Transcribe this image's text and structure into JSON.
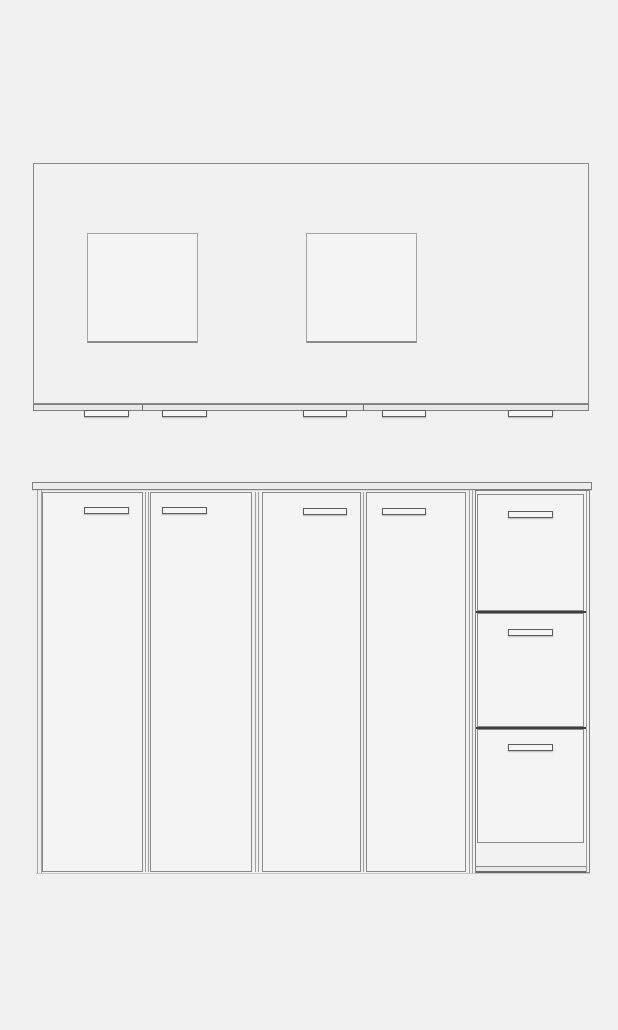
{
  "colors": {
    "background": "#f0f0f0",
    "surface": "#f4f4f4",
    "surface_light": "#f1f1f1",
    "counter_edge": "#ececec",
    "strip": "#e7e7e7",
    "line": "#8a8a8a",
    "divider_dark": "#3f3f3f"
  },
  "views": [
    {
      "name": "plan-view",
      "parts": [
        {
          "name": "countertop-top-surface",
          "kind": "surface-outline",
          "x": 33,
          "y": 163,
          "w": 556,
          "h": 241
        },
        {
          "name": "countertop-cutout-left",
          "kind": "cutout",
          "x": 87,
          "y": 233,
          "w": 111,
          "h": 110
        },
        {
          "name": "countertop-cutout-right",
          "kind": "cutout",
          "x": 306,
          "y": 233,
          "w": 111,
          "h": 110
        },
        {
          "name": "countertop-front-edge-strip",
          "kind": "strip",
          "x": 33,
          "y": 404,
          "w": 556,
          "h": 7
        },
        {
          "name": "front-strip-divider-left",
          "kind": "vline-dark",
          "x": 142,
          "y": 404,
          "w": 1,
          "h": 7
        },
        {
          "name": "front-strip-divider-right",
          "kind": "vline-dark",
          "x": 363,
          "y": 404,
          "w": 1,
          "h": 7
        },
        {
          "name": "plan-handle-1",
          "kind": "handle",
          "x": 84,
          "y": 410,
          "w": 45,
          "h": 7
        },
        {
          "name": "plan-handle-2",
          "kind": "handle",
          "x": 162,
          "y": 410,
          "w": 45,
          "h": 7
        },
        {
          "name": "plan-handle-3",
          "kind": "handle",
          "x": 303,
          "y": 410,
          "w": 44,
          "h": 7
        },
        {
          "name": "plan-handle-4",
          "kind": "handle",
          "x": 382,
          "y": 410,
          "w": 44,
          "h": 7
        },
        {
          "name": "plan-handle-5",
          "kind": "handle",
          "x": 508,
          "y": 410,
          "w": 45,
          "h": 7
        }
      ]
    },
    {
      "name": "elevation-view",
      "parts": [
        {
          "name": "countertop-front-edge",
          "kind": "counter-edge",
          "x": 32,
          "y": 482,
          "w": 560,
          "h": 8
        },
        {
          "name": "left-side-panel-outer-line",
          "kind": "vline",
          "x": 37,
          "y": 490,
          "w": 1,
          "h": 383
        },
        {
          "name": "left-side-panel-inner-line",
          "kind": "vline",
          "x": 41,
          "y": 490,
          "w": 1,
          "h": 383
        },
        {
          "name": "door-panel-1",
          "kind": "face",
          "x": 42,
          "y": 492,
          "w": 101,
          "h": 380
        },
        {
          "name": "door-panel-2",
          "kind": "face",
          "x": 150,
          "y": 492,
          "w": 102,
          "h": 380
        },
        {
          "name": "door-panel-3",
          "kind": "face",
          "x": 262,
          "y": 492,
          "w": 99,
          "h": 380
        },
        {
          "name": "door-panel-4",
          "kind": "face",
          "x": 366,
          "y": 492,
          "w": 100,
          "h": 380
        },
        {
          "name": "door-gap-line-1a",
          "kind": "vline",
          "x": 145,
          "y": 492,
          "w": 1,
          "h": 380
        },
        {
          "name": "door-gap-line-1b",
          "kind": "vline",
          "x": 148,
          "y": 492,
          "w": 1,
          "h": 380
        },
        {
          "name": "door-gap-line-2a",
          "kind": "vline",
          "x": 255,
          "y": 492,
          "w": 1,
          "h": 380
        },
        {
          "name": "door-gap-line-2b",
          "kind": "vline",
          "x": 258,
          "y": 492,
          "w": 1,
          "h": 380
        },
        {
          "name": "door-gap-line-3",
          "kind": "vline",
          "x": 363,
          "y": 492,
          "w": 1,
          "h": 380
        },
        {
          "name": "drawer-gap-line-a",
          "kind": "vline",
          "x": 469,
          "y": 490,
          "w": 1,
          "h": 383
        },
        {
          "name": "drawer-gap-line-b",
          "kind": "vline",
          "x": 472,
          "y": 490,
          "w": 1,
          "h": 383
        },
        {
          "name": "drawer-unit-box",
          "kind": "box",
          "x": 475,
          "y": 490,
          "w": 115,
          "h": 383
        },
        {
          "name": "drawer-unit-inner-right-line",
          "kind": "vline",
          "x": 586,
          "y": 491,
          "w": 1,
          "h": 381
        },
        {
          "name": "drawer-front-1",
          "kind": "face",
          "x": 477,
          "y": 494,
          "w": 107,
          "h": 117
        },
        {
          "name": "drawer-front-2",
          "kind": "face",
          "x": 477,
          "y": 613,
          "w": 107,
          "h": 114
        },
        {
          "name": "drawer-front-3",
          "kind": "face",
          "x": 477,
          "y": 729,
          "w": 107,
          "h": 114
        },
        {
          "name": "drawer-divider-line-1",
          "kind": "darkline",
          "x": 476,
          "y": 611,
          "w": 110,
          "h": 2
        },
        {
          "name": "drawer-divider-line-2",
          "kind": "darkline",
          "x": 476,
          "y": 727,
          "w": 110,
          "h": 2
        },
        {
          "name": "drawer-plinth",
          "kind": "plinth",
          "x": 476,
          "y": 866,
          "w": 110,
          "h": 7
        },
        {
          "name": "base-shadow-line",
          "kind": "hline-soft",
          "x": 36,
          "y": 873,
          "w": 554,
          "h": 1
        },
        {
          "name": "door-handle-1",
          "kind": "handle",
          "x": 84,
          "y": 507,
          "w": 45,
          "h": 7
        },
        {
          "name": "door-handle-2",
          "kind": "handle",
          "x": 162,
          "y": 507,
          "w": 45,
          "h": 7
        },
        {
          "name": "door-handle-3",
          "kind": "handle",
          "x": 303,
          "y": 508,
          "w": 44,
          "h": 7
        },
        {
          "name": "door-handle-4",
          "kind": "handle",
          "x": 382,
          "y": 508,
          "w": 44,
          "h": 7
        },
        {
          "name": "drawer-handle-1",
          "kind": "handle",
          "x": 508,
          "y": 511,
          "w": 45,
          "h": 7
        },
        {
          "name": "drawer-handle-2",
          "kind": "handle",
          "x": 508,
          "y": 629,
          "w": 45,
          "h": 7
        },
        {
          "name": "drawer-handle-3",
          "kind": "handle",
          "x": 508,
          "y": 744,
          "w": 45,
          "h": 7
        }
      ]
    }
  ]
}
